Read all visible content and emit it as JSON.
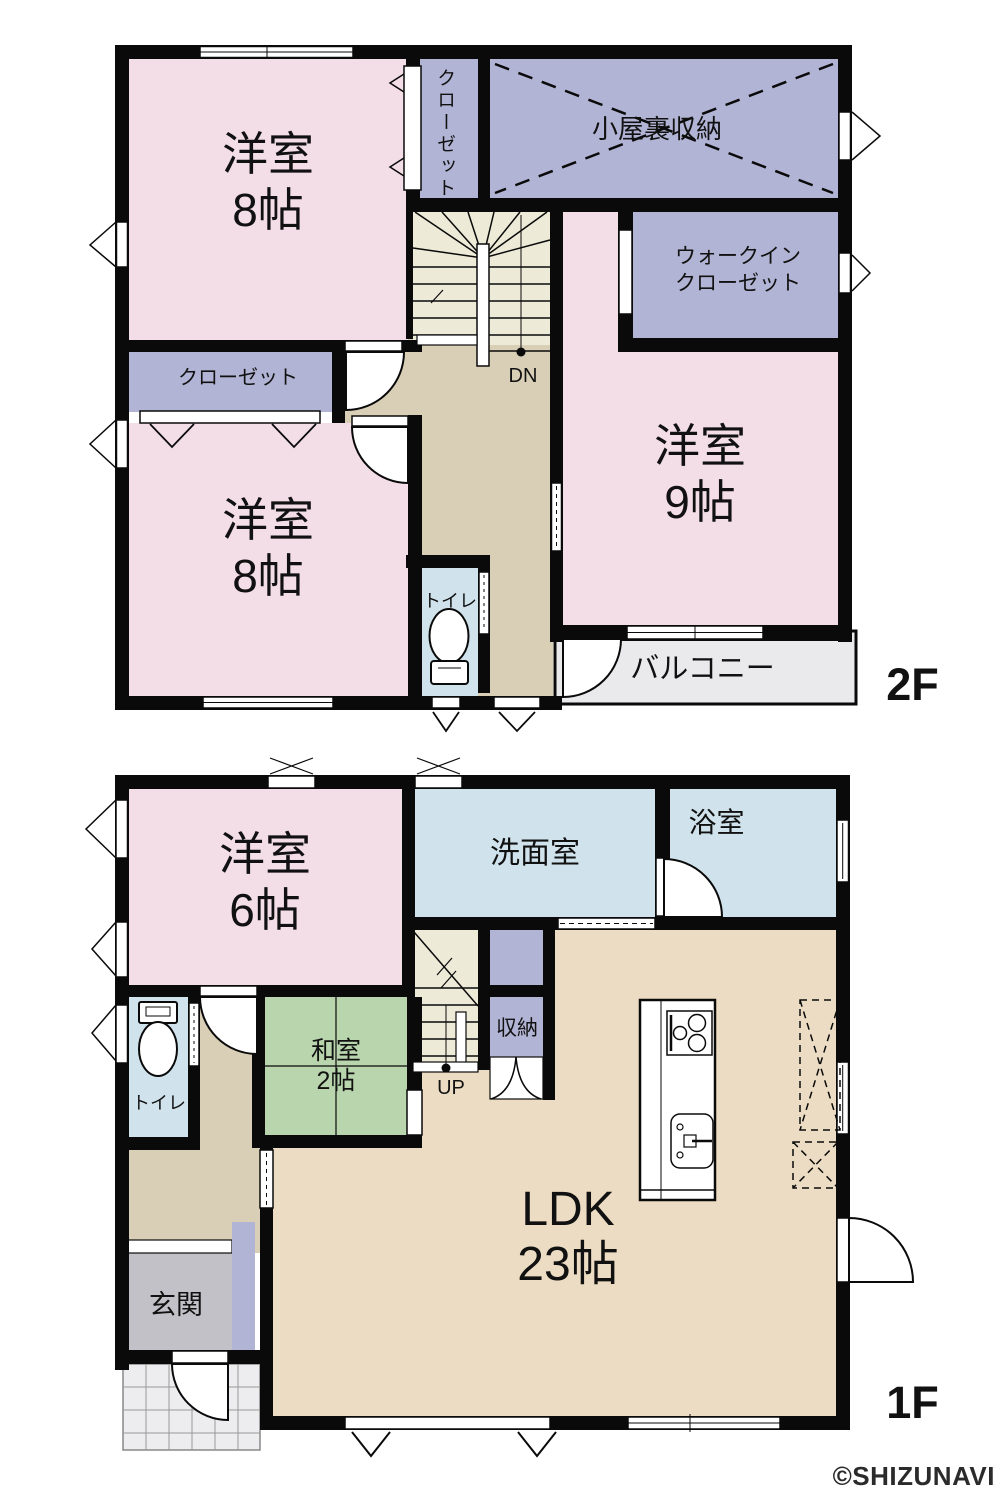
{
  "floor2": {
    "floor_label": "2F",
    "rooms": {
      "western8_top": {
        "name": "洋室",
        "size": "8帖"
      },
      "closet_top": {
        "name": "クローゼット"
      },
      "attic_storage": {
        "name": "小屋裏収納"
      },
      "walk_in_closet": {
        "line1": "ウォークイン",
        "line2": "クローゼット"
      },
      "western9": {
        "name": "洋室",
        "size": "9帖"
      },
      "closet_mid": {
        "name": "クローゼット"
      },
      "western8_bottom": {
        "name": "洋室",
        "size": "8帖"
      },
      "toilet": {
        "name": "トイレ"
      },
      "balcony": {
        "name": "バルコニー"
      },
      "stairs_direction": "DN"
    }
  },
  "floor1": {
    "floor_label": "1F",
    "rooms": {
      "western6": {
        "name": "洋室",
        "size": "6帖"
      },
      "washroom": {
        "name": "洗面室"
      },
      "bathroom": {
        "name": "浴室"
      },
      "storage": {
        "name": "収納"
      },
      "japanese_room": {
        "name": "和室",
        "size": "2帖"
      },
      "toilet": {
        "name": "トイレ"
      },
      "entrance": {
        "name": "玄関"
      },
      "ldk": {
        "name": "LDK",
        "size": "23帖"
      },
      "stairs_direction": "UP"
    }
  },
  "watermark": "©SHIZUNAVI",
  "colors": {
    "wall": "#0a0a0a",
    "western_room_pink": "#f3dde7",
    "closet_purple": "#b2b4d5",
    "corridor_tan": "#d8cfb6",
    "ldk_beige": "#ecdcc3",
    "stairs_cream": "#edead8",
    "wet_area_blue": "#d0e3ed",
    "tatami_green": "#b8d5ad",
    "entrance_gray": "#c2c1c7",
    "balcony_gray": "#eaeaec"
  }
}
